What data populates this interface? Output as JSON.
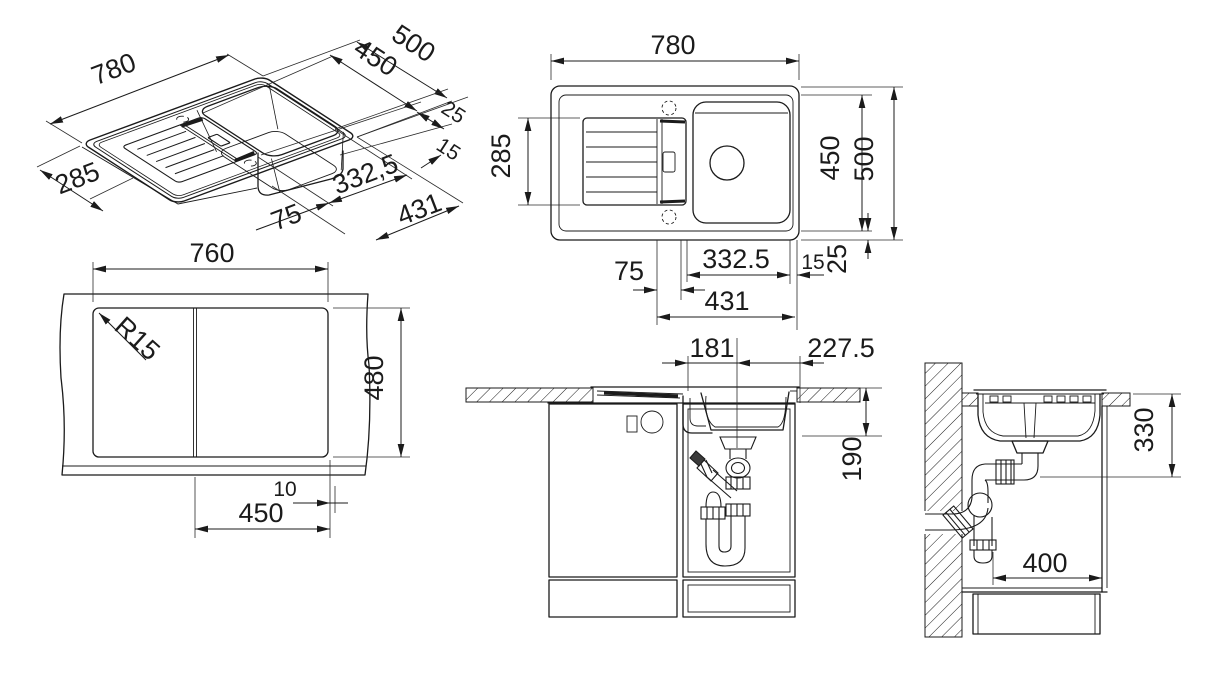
{
  "views": {
    "isometric": {
      "dim_780": "780",
      "dim_500": "500",
      "dim_450": "450",
      "dim_25": "25",
      "dim_15": "15",
      "dim_332_5": "332,5",
      "dim_431": "431",
      "dim_75": "75",
      "dim_285": "285"
    },
    "top": {
      "dim_780": "780",
      "dim_285": "285",
      "dim_450": "450",
      "dim_500": "500",
      "dim_75": "75",
      "dim_332_5": "332.5",
      "dim_15": "15",
      "dim_25": "25",
      "dim_431": "431"
    },
    "cutout": {
      "dim_760": "760",
      "radius": "R15",
      "dim_480": "480",
      "dim_10": "10",
      "dim_450": "450"
    },
    "front_section": {
      "dim_181": "181",
      "dim_227_5": "227.5",
      "dim_190": "190"
    },
    "side_section": {
      "dim_330": "330",
      "dim_400": "400"
    }
  },
  "colors": {
    "line": "#1b1b1b",
    "background": "#ffffff"
  }
}
